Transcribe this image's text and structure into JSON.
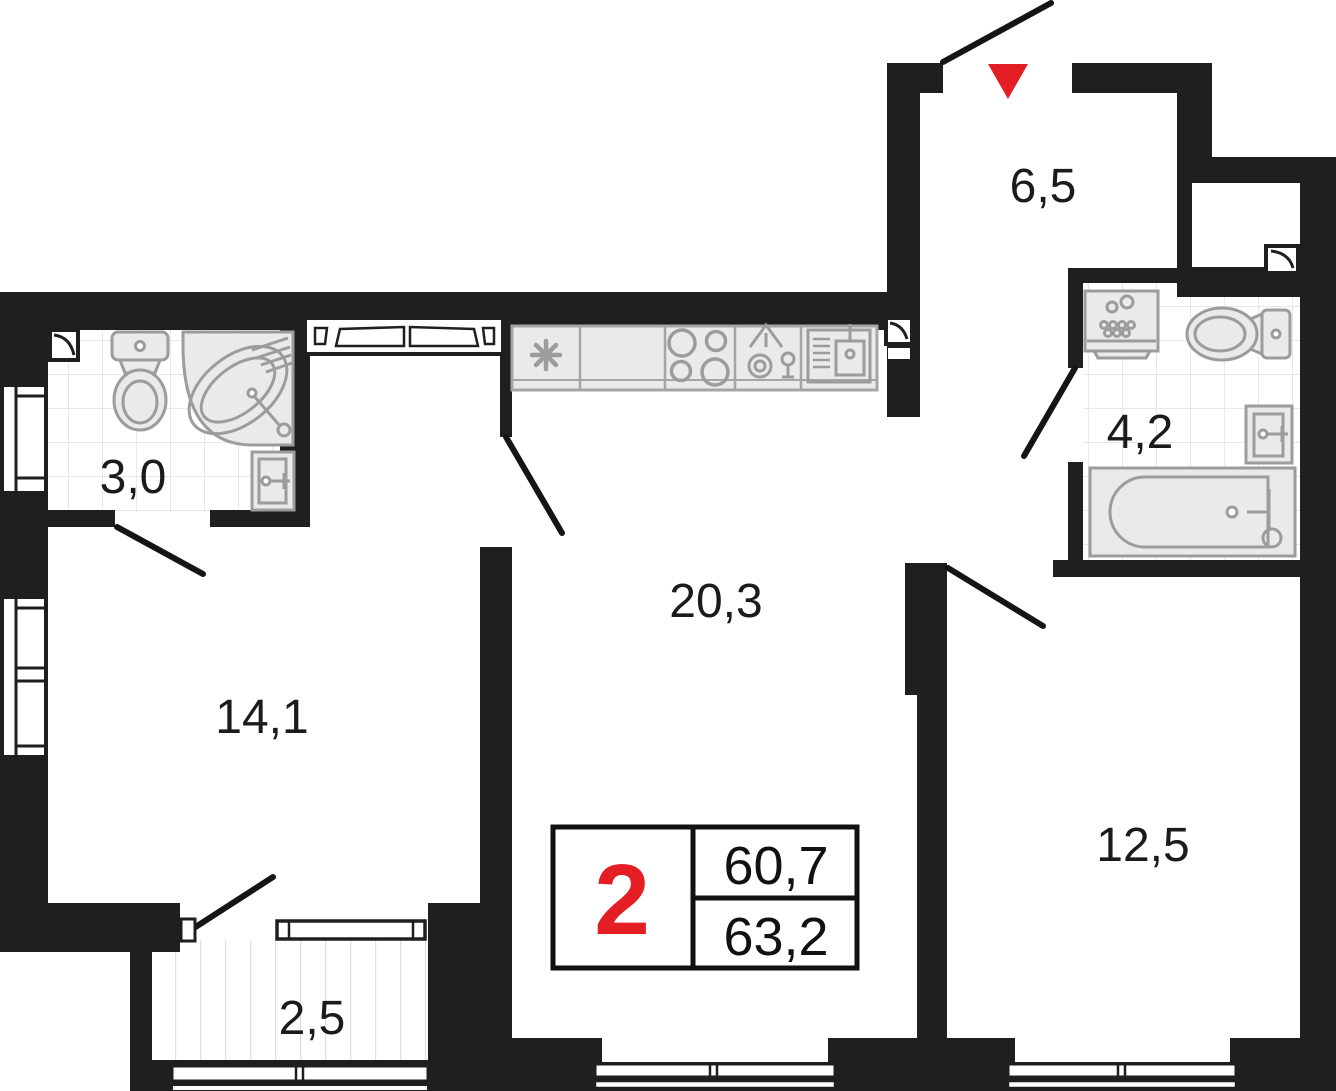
{
  "plan_type": "apartment-floor-plan",
  "rooms": {
    "hallway": {
      "area": "6,5"
    },
    "bathroom_small": {
      "area": "3,0"
    },
    "bathroom_large": {
      "area": "4,2"
    },
    "kitchen_living": {
      "area": "20,3"
    },
    "room_left": {
      "area": "14,1"
    },
    "room_right": {
      "area": "12,5"
    },
    "balcony": {
      "area": "2,5"
    }
  },
  "legend": {
    "rooms_count": "2",
    "area_living": "60,7",
    "area_total": "63,2"
  },
  "colors": {
    "wall": "#1f1f1f",
    "accent_red": "#e31e24",
    "fixture_fill": "#eaeaea",
    "fixture_stroke": "#9c9c9c",
    "tile_line": "#e8e8e8",
    "label_text": "#1b1b1b"
  },
  "icons": [
    "entrance-arrow",
    "door-swing",
    "window",
    "ventilation-shaft",
    "toilet",
    "corner-bathtub",
    "bathtub",
    "sink",
    "washing-machine",
    "fridge",
    "stove",
    "dishwasher",
    "kitchen-sink"
  ]
}
